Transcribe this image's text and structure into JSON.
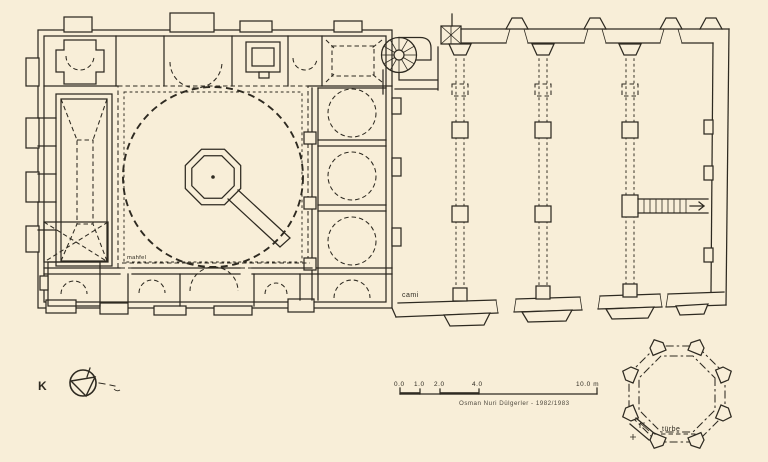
{
  "colors": {
    "paper": "#f8eed8",
    "ink": "#2e2a21"
  },
  "plan": {
    "labels": {
      "mosque": "cami",
      "tomb": "türbe",
      "hall": "mahfel",
      "north_letter": "K"
    },
    "scale_bar": {
      "ticks": [
        "0.0",
        "1.0",
        "2.0",
        "4.0"
      ],
      "end_label": "10.0 m",
      "attribution": "Osman Nuri Dülgerler - 1982/1983"
    }
  }
}
